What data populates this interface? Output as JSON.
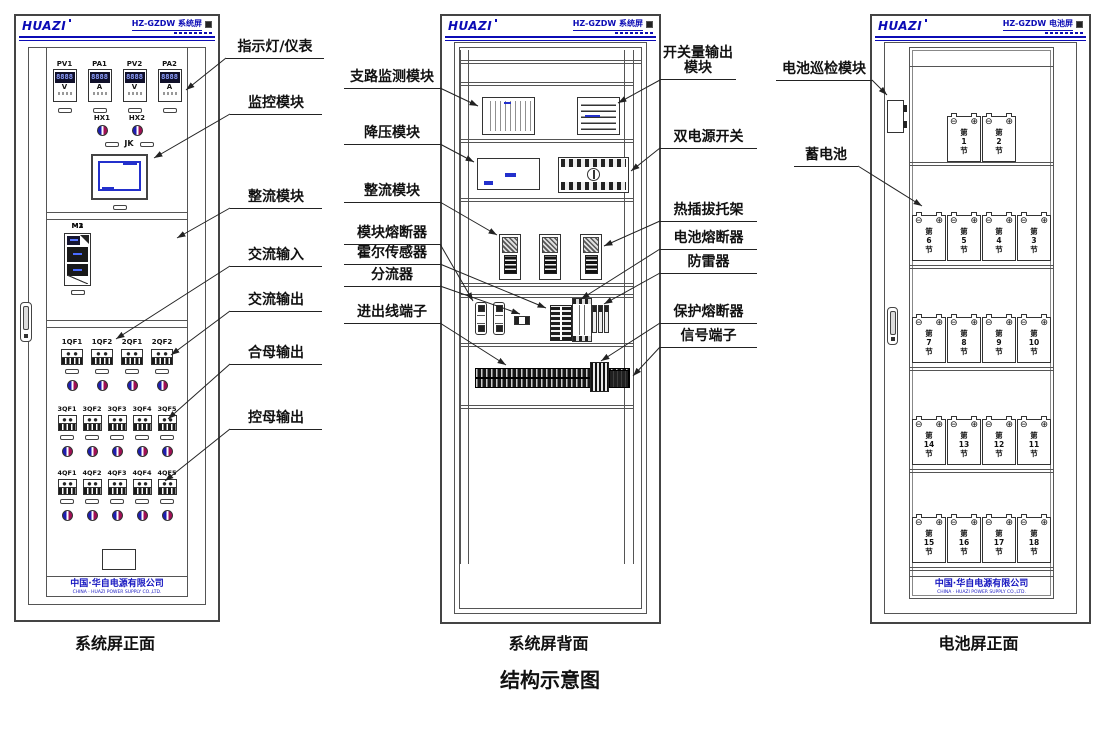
{
  "title": "结构示意图",
  "brand": {
    "logo": "HUAZI",
    "company_cn": "中国·华自电源有限公司",
    "company_en": "CHINA · HUAZI POWER SUPPLY CO.,LTD."
  },
  "panels": {
    "system_front": {
      "header_model": "HZ-GZDW 系统屏",
      "caption": "系统屏正面",
      "meters": [
        {
          "name": "PV1",
          "display": "8888",
          "unit": "V"
        },
        {
          "name": "PA1",
          "display": "8888",
          "unit": "A"
        },
        {
          "name": "PV2",
          "display": "8888",
          "unit": "V"
        },
        {
          "name": "PA2",
          "display": "8888",
          "unit": "A"
        }
      ],
      "indicators": [
        "HX1",
        "HX2"
      ],
      "jk_label": "JK",
      "rectifier_modules": [
        "M1",
        "M2",
        "M3"
      ],
      "breaker_rows": [
        [
          "1QF1",
          "1QF2",
          "2QF1",
          "2QF2"
        ],
        [
          "3QF1",
          "3QF2",
          "3QF3",
          "3QF4",
          "3QF5"
        ],
        [
          "4QF1",
          "4QF2",
          "4QF3",
          "4QF4",
          "4QF5"
        ]
      ],
      "annotations": [
        "指示灯/仪表",
        "监控模块",
        "整流模块",
        "交流输入",
        "交流输出",
        "合母输出",
        "控母输出"
      ]
    },
    "system_back": {
      "header_model": "HZ-GZDW 系统屏",
      "caption": "系统屏背面",
      "annotations_left": [
        "支路监测模块",
        "降压模块",
        "整流模块",
        "模块熔断器",
        "霍尔传感器",
        "分流器",
        "进出线端子"
      ],
      "annotations_right": [
        "开关量输出模块",
        "双电源开关",
        "热插拔托架",
        "电池熔断器",
        "防雷器",
        "保护熔断器",
        "信号端子"
      ]
    },
    "battery_front": {
      "header_model": "HZ-GZDW 电池屏",
      "caption": "电池屏正面",
      "annotations": [
        "电池巡检模块",
        "蓄电池"
      ],
      "battery_prefix": "第",
      "battery_suffix": "节",
      "terminal_minus": "⊖",
      "terminal_plus": "⊕",
      "battery_rows": [
        [
          1,
          2
        ],
        [
          6,
          5,
          4,
          3
        ],
        [
          7,
          8,
          9,
          10
        ],
        [
          14,
          13,
          12,
          11
        ],
        [
          15,
          16,
          17,
          18
        ]
      ]
    }
  }
}
